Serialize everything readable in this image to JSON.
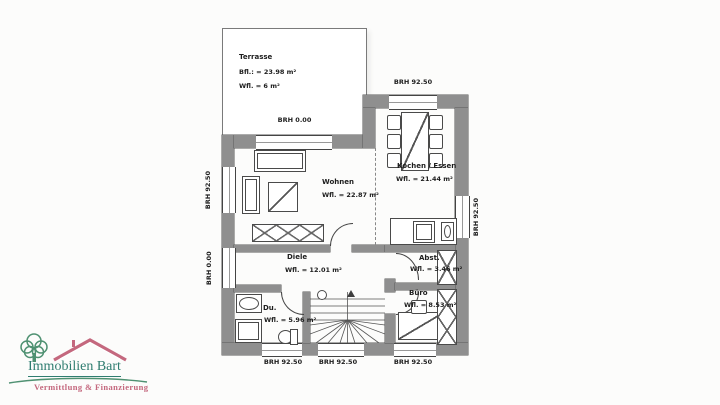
{
  "plan": {
    "terrasse": {
      "name": "Terrasse",
      "bfl": "Bfl.: = 23.98 m²",
      "wfl": "Wfl. = 6 m²",
      "brh": "BRH 0.00"
    },
    "rooms": {
      "wohnen": {
        "name": "Wohnen",
        "area": "Wfl. = 22.87 m²"
      },
      "kochen": {
        "name": "Kochen / Essen",
        "area": "Wfl. = 21.44 m²"
      },
      "diele": {
        "name": "Diele",
        "area": "Wfl. = 12.01 m²"
      },
      "abst": {
        "name": "Abst.",
        "area": "Wfl. = 3.46 m²"
      },
      "buero": {
        "name": "Büro",
        "area": "Wfl. = 8.53 m²"
      },
      "du": {
        "name": "Du.",
        "area": "Wfl. = 5.96 m²"
      }
    },
    "marks": {
      "top": "BRH 92.50",
      "left_upper": "BRH 92.50",
      "left_lower": "BRH 0.00",
      "right": "BRH 92.50",
      "bottom_left": "BRH 92.50",
      "bottom_mid": "BRH 92.50",
      "bottom_right": "BRH 92.50"
    }
  },
  "logo": {
    "title": "Immobilien Bart",
    "subtitle": "Vermittlung & Finanzierung"
  },
  "colors": {
    "wall": "#8f8f8f",
    "line": "#444444",
    "logo_teal": "#2f7d70",
    "logo_green": "#4f9172",
    "logo_rose": "#c4687e"
  }
}
